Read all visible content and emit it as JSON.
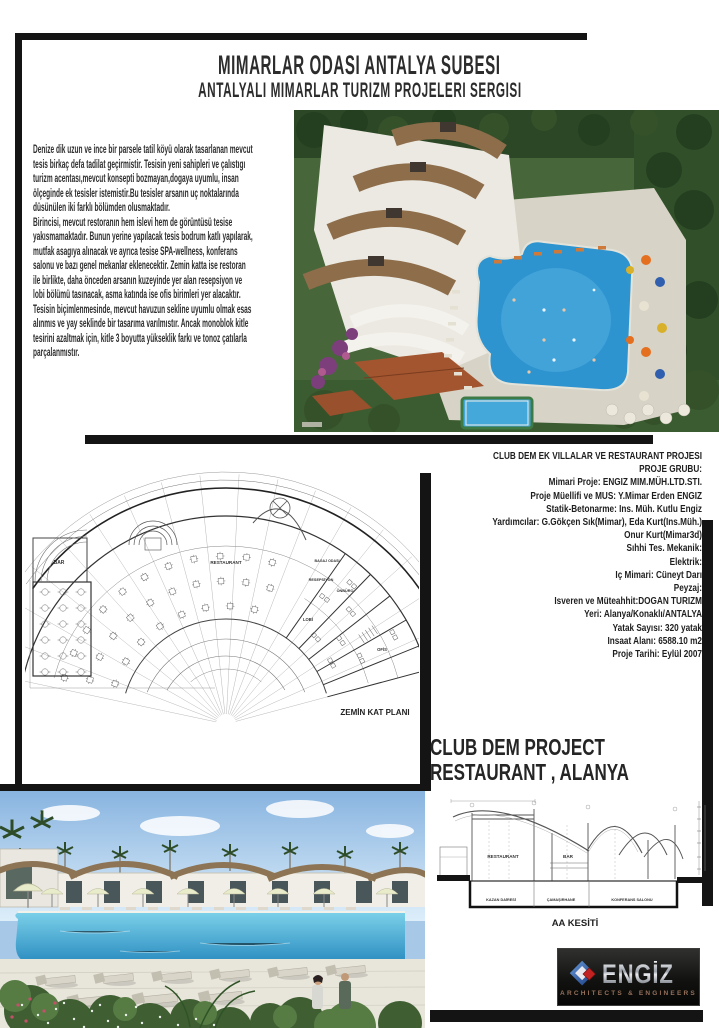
{
  "header": {
    "title_line1": "MIMARLAR ODASI ANTALYA SUBESI",
    "title_line2": "ANTALYALI MIMARLAR TURIZM PROJELERI SERGISI"
  },
  "description": {
    "text": "Denize dik uzun ve ince bir parsele tatil köyü olarak tasarlanan mevcut\ntesis birkaç defa tadilat geçirmistir. Tesisin yeni sahipleri ve çalıstıgı\nturizm acentası,mevcut konsepti  bozmayan,dogaya uyumlu, insan\nölçeginde ek tesisler istemistir.Bu tesisler arsanın uç noktalarında\ndüsünülen iki farklı bölümden olusmaktadır.\nBirincisi, mevcut restoranın hem islevi hem de görüntüsü tesise\nyakısmamaktadır. Bunun yerine yapılacak tesis bodrum katlı yapılarak,\nmutfak asagıya alınacak ve ayrıca tesise SPA-wellness, konferans\nsalonu ve bazı genel mekanlar eklenecektir. Zemin katta ise restoran\nile birlikte, daha önceden arsanın kuzeyinde yer alan resepsiyon ve\nlobi bölümü tasınacak, asma katında ise ofis birimleri yer alacaktır.\nTesisin biçimlenmesinde, mevcut havuzun sekline uyumlu olmak esas\nalınmıs ve yay seklinde bir tasarıma varılmıstır. Ancak monoblok kitle\ntesirini azaltmak için, kitle 3 boyutta yükseklik farkı ve tonoz çatılarla\nparçalanmıstır."
  },
  "credits": {
    "lines": [
      "CLUB DEM EK VILLALAR VE RESTAURANT PROJESI",
      "PROJE GRUBU:",
      "Mimari Proje: ENGIZ MIM.MÜH.LTD.STI.",
      "Proje Müellifi ve MUS: Y.Mimar Erden ENGIZ",
      "Statik-Betonarme: Ins. Müh. Kutlu Engiz",
      "Yardımcılar: G.Gökçen Sık(Mimar), Eda Kurt(Ins.Müh.)",
      "Onur Kurt(Mimar3d)",
      "Sıhhi Tes. Mekanik:",
      "Elektrik:",
      "Iç Mimari: Cüneyt Darı",
      "Peyzaj:",
      "Isveren ve Müteahhit:DOGAN TURIZM",
      "Yeri: Alanya/Konaklı/ANTALYA",
      "Yatak Sayısı: 320 yatak",
      "Insaat Alanı: 6588.10 m2",
      "Proje Tarihi: Eylül 2007"
    ]
  },
  "project": {
    "title_line1": "CLUB DEM PROJECT",
    "title_line2": "RESTAURANT , ALANYA"
  },
  "plan": {
    "caption": "ZEMİN KAT PLANI",
    "labels": {
      "bar": "BAR",
      "restaurant": "RESTAURANT",
      "bagaj": "BAGAJ ODASI",
      "resepsiyon": "RESEPSİYON",
      "onburo": "ÖNBÜRO",
      "lobi": "LOBİ",
      "ofis": "OFİS"
    }
  },
  "section": {
    "caption": "AA KESİTİ",
    "labels": {
      "restaurant": "RESTAURANT",
      "bar": "BAR",
      "kazan": "KAZAN DAİRESİ",
      "camasirhane": "ÇAMAŞIRHANE",
      "konferans": "KONFERANS SALONU"
    }
  },
  "logo": {
    "name": "ENGİZ",
    "tagline": "ARCHITECTS & ENGINEERS"
  },
  "colors": {
    "frame": "#141414",
    "pool_blue": "#2e94cf",
    "roof_brown": "#8e6d4b",
    "logo_background": "#161616",
    "logo_text_silver": "#c9ccd2",
    "logo_tagline_bronze": "#96705a"
  }
}
